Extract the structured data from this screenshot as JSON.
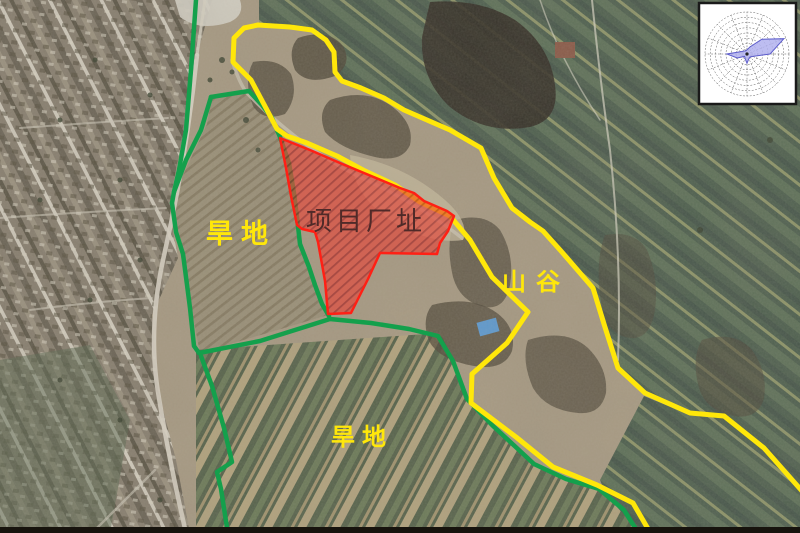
{
  "map": {
    "type": "annotated-satellite-map",
    "labels": {
      "dryland_upper": "旱地",
      "dryland_lower": "旱地",
      "valley": "山谷",
      "project_site": "项目厂址"
    },
    "colors": {
      "boundary_yellow": "#ffe70a",
      "boundary_green": "#14a04c",
      "site_fill": "#e5473a",
      "site_stroke": "#ff2015",
      "label_yellow": "#ffe70a",
      "site_label_color": "#4f2a28",
      "wind_rose_fill": "#b2b2ef"
    }
  },
  "wind_rose": {
    "type": "rose",
    "position": "top-right",
    "rings": 8,
    "directions": [
      "N",
      "NNE",
      "NE",
      "ENE",
      "E",
      "ESE",
      "SE",
      "SSE",
      "S",
      "SSW",
      "SW",
      "WSW",
      "W",
      "WNW",
      "NW",
      "NNW"
    ],
    "values": [
      0.1,
      0.18,
      0.5,
      0.95,
      0.55,
      0.15,
      0.1,
      0.12,
      0.22,
      0.12,
      0.08,
      0.25,
      0.48,
      0.15,
      0.1,
      0.08
    ]
  }
}
